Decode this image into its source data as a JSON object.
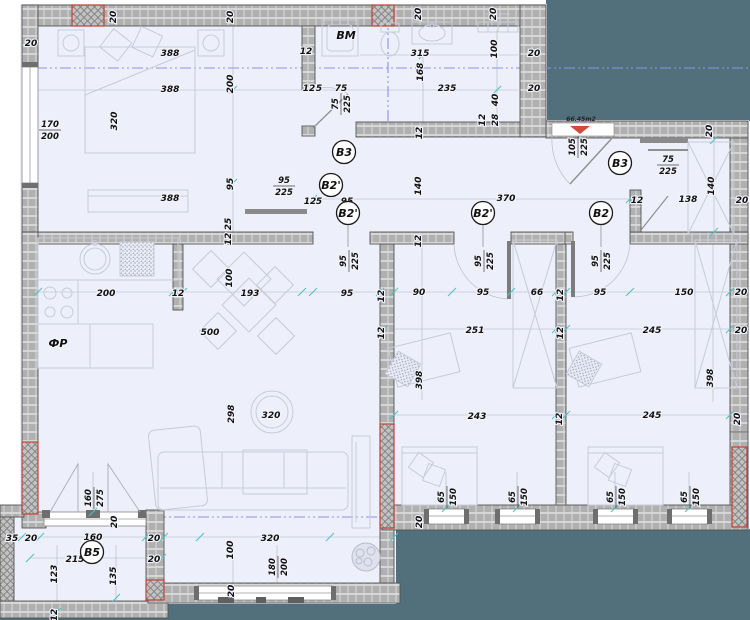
{
  "plan": {
    "title": "apartment-floor-plan",
    "colors": {
      "outside": "#51707b",
      "floor": "#edeffb",
      "wall": "#b0b0b0",
      "wall_line": "#e2e2e2",
      "wall_outline": "#555555",
      "insulation_red": "#c54134",
      "centerline": "#8a93e6",
      "tick": "#49c2c2",
      "furniture": "#c7cbd9",
      "label": "#101010"
    },
    "area_label": {
      "text": "66.45m2",
      "x": 581,
      "y": 121
    },
    "room_labels": [
      {
        "text": "BM",
        "x": 346,
        "y": 39
      },
      {
        "text": "ФР",
        "x": 58,
        "y": 347
      }
    ],
    "circle_labels": [
      {
        "text": "B3",
        "x": 344,
        "y": 152
      },
      {
        "text": "B2'",
        "x": 331,
        "y": 185
      },
      {
        "text": "B2'",
        "x": 348,
        "y": 213
      },
      {
        "text": "B2'",
        "x": 483,
        "y": 213
      },
      {
        "text": "B2",
        "x": 601,
        "y": 213
      },
      {
        "text": "B3",
        "x": 620,
        "y": 163
      },
      {
        "text": "B5",
        "x": 92,
        "y": 552
      }
    ],
    "dim_labels": [
      {
        "t": "20",
        "x": 116,
        "y": 17,
        "r": -90
      },
      {
        "t": "20",
        "x": 233,
        "y": 17,
        "r": -90
      },
      {
        "t": "20",
        "x": 421,
        "y": 14,
        "r": -90
      },
      {
        "t": "20",
        "x": 496,
        "y": 14,
        "r": -90
      },
      {
        "t": "20",
        "x": 31,
        "y": 46
      },
      {
        "t": "388",
        "x": 170,
        "y": 56
      },
      {
        "t": "12",
        "x": 306,
        "y": 54
      },
      {
        "t": "315",
        "x": 420,
        "y": 56
      },
      {
        "t": "100",
        "x": 497,
        "y": 49,
        "r": -90
      },
      {
        "t": "20",
        "x": 534,
        "y": 56
      },
      {
        "t": "388",
        "x": 170,
        "y": 92
      },
      {
        "t": "200",
        "x": 233,
        "y": 84,
        "r": -90
      },
      {
        "t": "235",
        "x": 447,
        "y": 91
      },
      {
        "t": "20",
        "x": 534,
        "y": 91
      },
      {
        "t": "12",
        "x": 309,
        "y": 91
      },
      {
        "t": "5",
        "x": 319,
        "y": 91
      },
      {
        "t": "75",
        "x": 341,
        "y": 91
      },
      {
        "t": "168",
        "x": 423,
        "y": 72,
        "r": -90
      },
      {
        "t": "40",
        "x": 498,
        "y": 100,
        "r": -90
      },
      {
        "t": "12",
        "x": 485,
        "y": 120,
        "r": -90
      },
      {
        "t": "28",
        "x": 498,
        "y": 120,
        "r": -90
      },
      {
        "t": "12",
        "x": 422,
        "y": 133,
        "r": -90
      },
      {
        "t": "320",
        "x": 117,
        "y": 121,
        "r": -90
      },
      {
        "t": "95",
        "x": 233,
        "y": 184,
        "r": -90
      },
      {
        "t": "388",
        "x": 170,
        "y": 201
      },
      {
        "t": "12",
        "x": 310,
        "y": 204
      },
      {
        "t": "5",
        "x": 319,
        "y": 204
      },
      {
        "t": "95",
        "x": 347,
        "y": 204
      },
      {
        "t": "25",
        "x": 231,
        "y": 224,
        "r": -90
      },
      {
        "t": "12",
        "x": 231,
        "y": 239,
        "r": -90
      },
      {
        "t": "140",
        "x": 421,
        "y": 186,
        "r": -90
      },
      {
        "t": "370",
        "x": 506,
        "y": 201
      },
      {
        "t": "12",
        "x": 637,
        "y": 203
      },
      {
        "t": "138",
        "x": 688,
        "y": 202
      },
      {
        "t": "140",
        "x": 714,
        "y": 186,
        "r": -90
      },
      {
        "t": "20",
        "x": 712,
        "y": 131,
        "r": -90
      },
      {
        "t": "20",
        "x": 742,
        "y": 203
      },
      {
        "t": "200",
        "x": 106,
        "y": 296
      },
      {
        "t": "12",
        "x": 178,
        "y": 296
      },
      {
        "t": "100",
        "x": 232,
        "y": 278,
        "r": -90
      },
      {
        "t": "193",
        "x": 250,
        "y": 296
      },
      {
        "t": "95",
        "x": 347,
        "y": 296
      },
      {
        "t": "500",
        "x": 210,
        "y": 335
      },
      {
        "t": "12",
        "x": 384,
        "y": 296,
        "r": -90
      },
      {
        "t": "12",
        "x": 384,
        "y": 333,
        "r": -90
      },
      {
        "t": "298",
        "x": 234,
        "y": 414,
        "r": -90
      },
      {
        "t": "320",
        "x": 271,
        "y": 418
      },
      {
        "t": "12",
        "x": 421,
        "y": 241,
        "r": -90
      },
      {
        "t": "90",
        "x": 419,
        "y": 295
      },
      {
        "t": "95",
        "x": 483,
        "y": 295
      },
      {
        "t": "66",
        "x": 537,
        "y": 295
      },
      {
        "t": "12",
        "x": 563,
        "y": 295,
        "r": -90
      },
      {
        "t": "251",
        "x": 475,
        "y": 333
      },
      {
        "t": "12",
        "x": 563,
        "y": 333,
        "r": -90
      },
      {
        "t": "398",
        "x": 422,
        "y": 380,
        "r": -90
      },
      {
        "t": "243",
        "x": 477,
        "y": 419
      },
      {
        "t": "12",
        "x": 562,
        "y": 419,
        "r": -90
      },
      {
        "t": "95",
        "x": 600,
        "y": 295
      },
      {
        "t": "150",
        "x": 684,
        "y": 295
      },
      {
        "t": "20",
        "x": 741,
        "y": 295
      },
      {
        "t": "245",
        "x": 652,
        "y": 333
      },
      {
        "t": "20",
        "x": 741,
        "y": 333
      },
      {
        "t": "398",
        "x": 713,
        "y": 378,
        "r": -90
      },
      {
        "t": "245",
        "x": 652,
        "y": 418
      },
      {
        "t": "20",
        "x": 740,
        "y": 419,
        "r": -90
      },
      {
        "t": "20",
        "x": 422,
        "y": 522,
        "r": -90
      },
      {
        "t": "35",
        "x": 12,
        "y": 541
      },
      {
        "t": "20",
        "x": 31,
        "y": 541
      },
      {
        "t": "160",
        "x": 93,
        "y": 540
      },
      {
        "t": "20",
        "x": 154,
        "y": 541
      },
      {
        "t": "215",
        "x": 75,
        "y": 562
      },
      {
        "t": "20",
        "x": 154,
        "y": 562
      },
      {
        "t": "123",
        "x": 57,
        "y": 574,
        "r": -90
      },
      {
        "t": "135",
        "x": 116,
        "y": 576,
        "r": -90
      },
      {
        "t": "12",
        "x": 57,
        "y": 615,
        "r": -90
      },
      {
        "t": "20",
        "x": 117,
        "y": 522,
        "r": -90
      },
      {
        "t": "320",
        "x": 270,
        "y": 541
      },
      {
        "t": "100",
        "x": 233,
        "y": 550,
        "r": -90
      },
      {
        "t": "20",
        "x": 234,
        "y": 591,
        "r": -90
      }
    ],
    "fraction_labels": [
      {
        "a": "170",
        "b": "200",
        "x": 50,
        "y": 129
      },
      {
        "a": "75",
        "b": "225",
        "x": 340,
        "y": 104,
        "r": -90
      },
      {
        "a": "95",
        "b": "225",
        "x": 284,
        "y": 185
      },
      {
        "a": "105",
        "b": "225",
        "x": 577,
        "y": 147,
        "r": -90
      },
      {
        "a": "75",
        "b": "225",
        "x": 668,
        "y": 164
      },
      {
        "a": "95",
        "b": "225",
        "x": 348,
        "y": 261,
        "r": -90
      },
      {
        "a": "95",
        "b": "225",
        "x": 483,
        "y": 261,
        "r": -90
      },
      {
        "a": "95",
        "b": "225",
        "x": 600,
        "y": 261,
        "r": -90
      },
      {
        "a": "65",
        "b": "150",
        "x": 446,
        "y": 497,
        "r": -90
      },
      {
        "a": "65",
        "b": "150",
        "x": 517,
        "y": 497,
        "r": -90
      },
      {
        "a": "65",
        "b": "150",
        "x": 615,
        "y": 497,
        "r": -90
      },
      {
        "a": "65",
        "b": "150",
        "x": 689,
        "y": 497,
        "r": -90
      },
      {
        "a": "160",
        "b": "275",
        "x": 93,
        "y": 498,
        "r": -90
      },
      {
        "a": "180",
        "b": "200",
        "x": 277,
        "y": 567,
        "r": -90
      }
    ]
  }
}
